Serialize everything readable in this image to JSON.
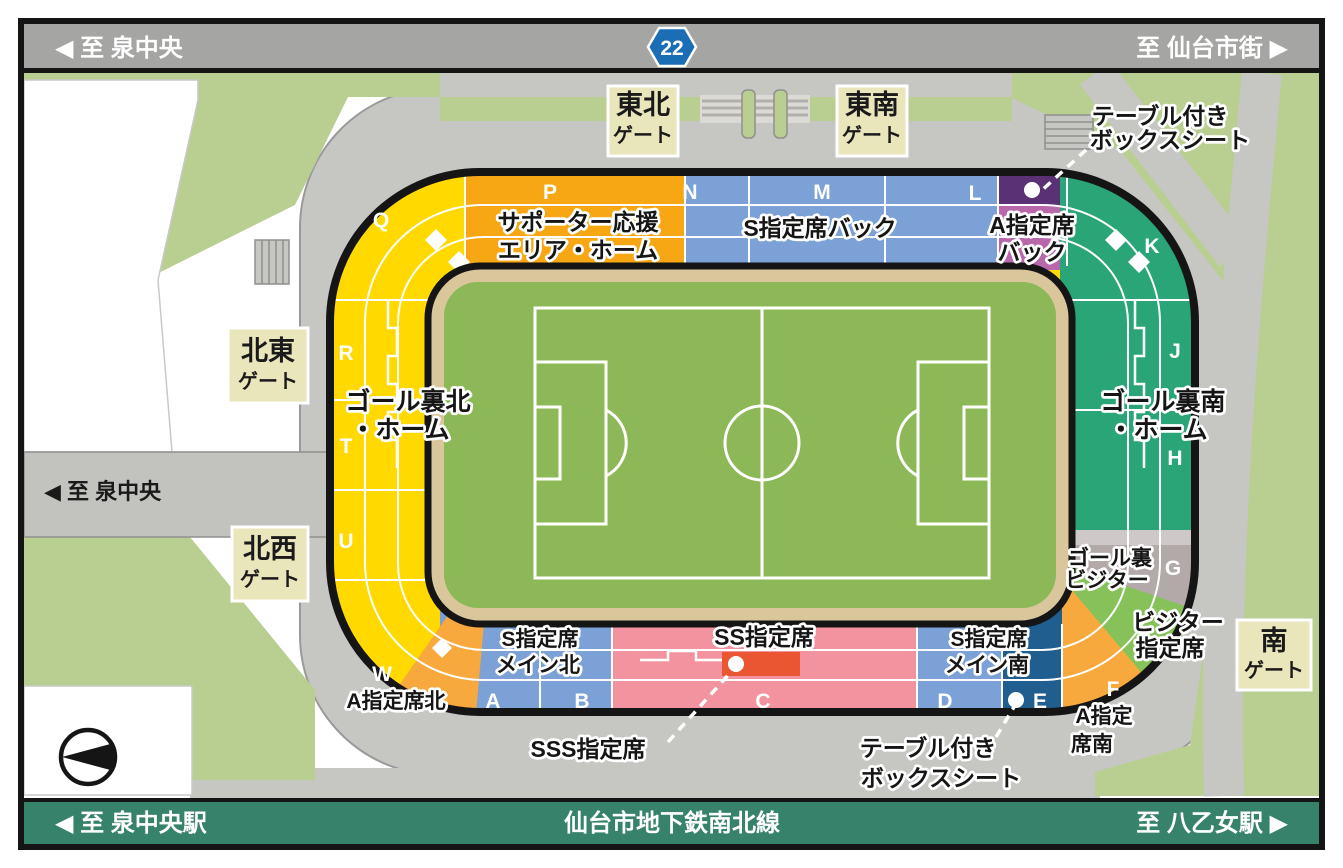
{
  "top_road": {
    "left": "◀ 至 泉中央",
    "route_badge": "22",
    "right": "至 仙台市街 ▶",
    "badge_color": "#1b6db5",
    "bar_color": "#a5a5a3"
  },
  "bottom_bar": {
    "left": "◀ 至 泉中央駅",
    "center": "仙台市地下鉄南北線",
    "right": "至 八乙女駅 ▶",
    "bar_color": "#37826b"
  },
  "road_label_left": "◀ 至 泉中央",
  "gates": {
    "tohoku": {
      "line1": "東北",
      "line2": "ゲート"
    },
    "tonan": {
      "line1": "東南",
      "line2": "ゲート"
    },
    "hokuto": {
      "line1": "北東",
      "line2": "ゲート"
    },
    "hokusei": {
      "line1": "北西",
      "line2": "ゲート"
    },
    "minami": {
      "line1": "南",
      "line2": "ゲート"
    },
    "box_color": "#e9e6bc"
  },
  "sections": {
    "supporter": {
      "name_line1": "サポーター応援",
      "name_line2": "エリア・ホーム",
      "block": "P",
      "color": "#f6a713"
    },
    "s_back": {
      "name": "S指定席バック",
      "blocks": [
        "N",
        "M",
        "L"
      ],
      "color": "#7ba1d7"
    },
    "a_back": {
      "name_line1": "A指定席",
      "name_line2": "バック",
      "color": "#b767aa",
      "box_color": "#5a3174"
    },
    "goal_north": {
      "name_line1": "ゴール裏北",
      "name_line2": "・ホーム",
      "blocks": [
        "Q",
        "R",
        "T",
        "U",
        "W"
      ],
      "color": "#ffd900"
    },
    "goal_south": {
      "name_line1": "ゴール裏南",
      "name_line2": "・ホーム",
      "blocks": [
        "K",
        "J",
        "H"
      ],
      "color": "#2aa577"
    },
    "goal_visitor": {
      "name_line1": "ゴール裏",
      "name_line2": "ビジター",
      "block": "G",
      "color": "#b3a9a9"
    },
    "visitor": {
      "name_line1": "ビジター",
      "name_line2": "指定席",
      "color": "#86c159"
    },
    "a_north": {
      "name": "A指定席北",
      "color": "#f7a93d"
    },
    "a_south": {
      "name_line1": "A指定",
      "name_line2": "席南",
      "block": "F",
      "color": "#f7a93d"
    },
    "s_main_north": {
      "name_line1": "S指定席",
      "name_line2": "メイン北",
      "blocks": [
        "A",
        "B"
      ],
      "color": "#7ba1d7"
    },
    "s_main_south": {
      "name_line1": "S指定席",
      "name_line2": "メイン南",
      "block": "D",
      "color": "#7ba1d7"
    },
    "ss": {
      "name": "SS指定席",
      "block": "C",
      "color": "#f2939f"
    },
    "sss": {
      "name": "SSS指定席",
      "color": "#ea5532"
    },
    "e_block": {
      "block": "E",
      "color": "#205e90"
    },
    "table_box_back": {
      "name_line1": "テーブル付き",
      "name_line2": "ボックスシート"
    },
    "table_box_main": {
      "name_line1": "テーブル付き",
      "name_line2": "ボックスシート"
    }
  },
  "map_colors": {
    "grass": "#b9cf92",
    "plaza": "#c6c6c3",
    "track": "#d9c69b",
    "pitch": "#8cb857",
    "outline": "#151515"
  }
}
